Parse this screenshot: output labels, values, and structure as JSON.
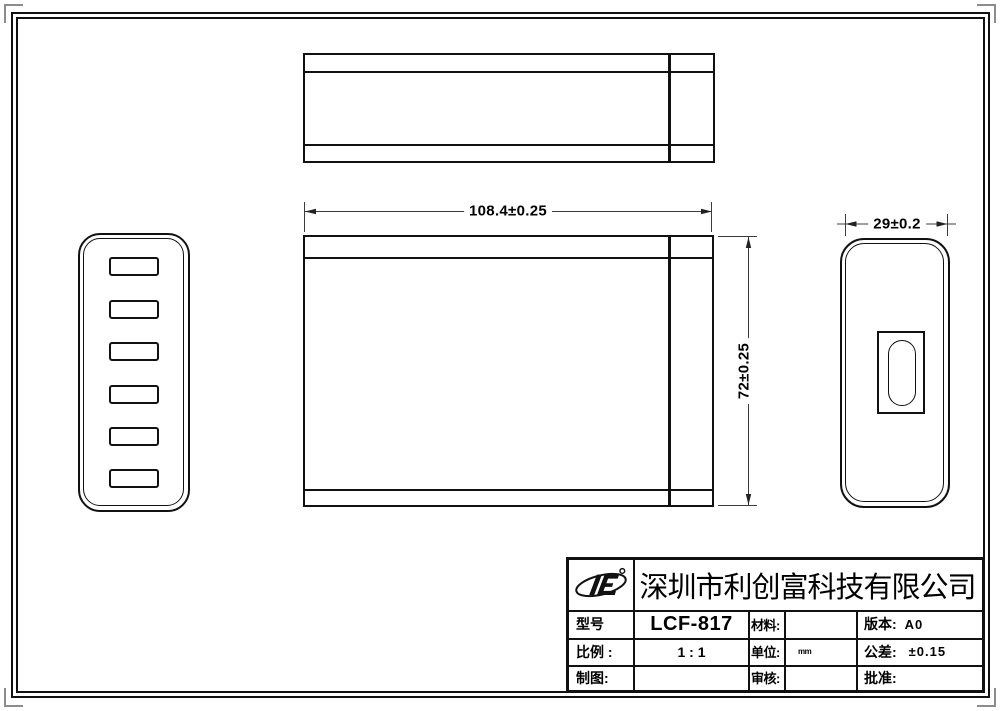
{
  "drawing": {
    "dim_width": "108.4±0.25",
    "dim_height": "72±0.25",
    "dim_depth": "29±0.2"
  },
  "title_block": {
    "company": "深圳市利创富科技有限公司",
    "model_label": "型号",
    "model_value": "LCF-817",
    "material_label": "材料:",
    "material_value": "",
    "version_label": "版本:",
    "version_value": "A0",
    "scale_label": "比例 :",
    "scale_value": "1 : 1",
    "unit_label": "单位:",
    "unit_value": "mm",
    "tolerance_label": "公差:",
    "tolerance_value": "±0.15",
    "draft_label": "制图:",
    "draft_value": "",
    "review_label": "审核:",
    "review_value": "",
    "approve_label": "批准:",
    "approve_value": ""
  },
  "icons": {
    "logo": "orbit-letters-company-logo"
  },
  "colors": {
    "line": "#111111",
    "dim_line": "#3c3c3c",
    "corner_mark": "#8c8c8c",
    "background": "#ffffff"
  }
}
